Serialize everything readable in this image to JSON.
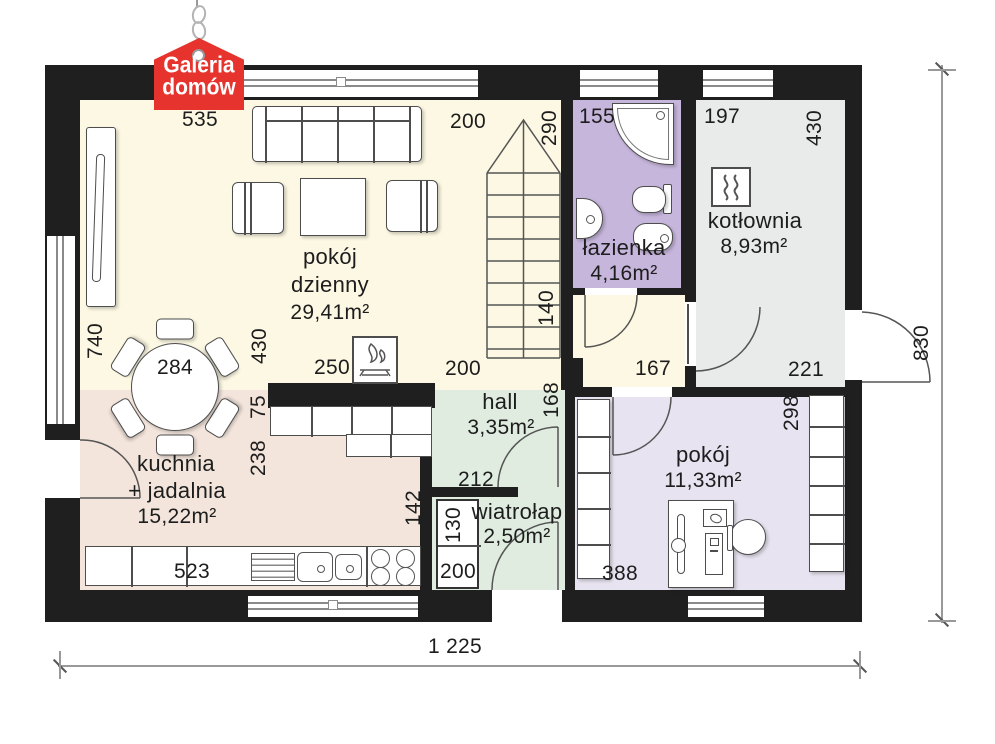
{
  "logo": {
    "line1": "Galeria",
    "line2": "domów"
  },
  "rooms": {
    "living": {
      "name_line1": "pokój",
      "name_line2": "dzienny",
      "area": "29,41m²"
    },
    "bathroom": {
      "name": "łazienka",
      "area": "4,16m²"
    },
    "boiler_room": {
      "name": "kotłownia",
      "area": "8,93m²"
    },
    "hall": {
      "name": "hall",
      "area": "3,35m²"
    },
    "vestibule": {
      "name": "wiatrołap",
      "area": "2,50m²"
    },
    "kitchen": {
      "name_line1": "kuchnia",
      "name_line2": "+ jadalnia",
      "area": "15,22m²"
    },
    "bedroom": {
      "name": "pokój",
      "area": "11,33m²"
    }
  },
  "dimensions": {
    "living_window_top": "535",
    "living_top_right": "200",
    "bathroom_top": "155",
    "boiler_top": "197",
    "boiler_right": "430",
    "bathroom_left": "290",
    "stairs_left": "140",
    "living_left": "740",
    "dining_table": "284",
    "living_height_left": "430",
    "fireplace_left": "250",
    "living_opening": "200",
    "corridor_bottom": "167",
    "boiler_door": "221",
    "counter_depth": "75",
    "kitchen_right": "238",
    "hall_right": "168",
    "hall_bottom": "212",
    "bedroom_right": "298",
    "kitchen_wall_right": "142",
    "vestibule_wardrobe_width": "130",
    "vestibule_wardrobe_depth": "200",
    "kitchen_window_bottom": "523",
    "bedroom_bottom": "388",
    "overall_width": "1 225",
    "overall_height": "830"
  },
  "colors": {
    "wall": "#1f1f1f",
    "living": "#fcf8e3",
    "kitchen": "#f3e5dc",
    "bathroom": "#c7b6dc",
    "boiler": "#e9eBea",
    "hall": "#dfecdf",
    "bedroom": "#e7e3f0",
    "logo": "#e6332d"
  }
}
